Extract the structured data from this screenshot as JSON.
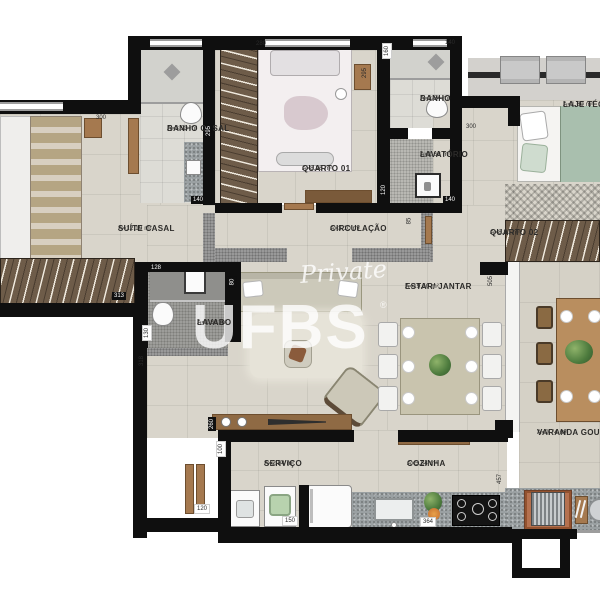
{
  "plan_title": "apartment-floor-plan",
  "watermark": {
    "script": "Private",
    "brand": "UFBS",
    "registered": "®"
  },
  "rooms": [
    {
      "id": "banho-casal",
      "name": "BANHO CASAL",
      "area": "A=3,93 m²"
    },
    {
      "id": "quarto-01",
      "name": "QUARTO 01",
      "area": "A=8,26 m²"
    },
    {
      "id": "banho",
      "name": "BANHO",
      "area": "A=2,24 m²"
    },
    {
      "id": "lavatorio",
      "name": "LAVATÓRIO",
      "area": "A=1,68 m²"
    },
    {
      "id": "laje-tecnica",
      "name": "LAJE TÉCNICA",
      "area": "A=1,60 m²"
    },
    {
      "id": "quarto-02",
      "name": "QUARTO 02",
      "area": "A=8,20 m²"
    },
    {
      "id": "suite-casal",
      "name": "SUÍTE CASAL",
      "area": "A=12,19 m²"
    },
    {
      "id": "circulacao",
      "name": "CIRCULAÇÃO",
      "area": "A=3,10 m²"
    },
    {
      "id": "lavabo",
      "name": "LAVABO",
      "area": "A=1,66 m²"
    },
    {
      "id": "estar-jantar",
      "name": "ESTAR/ JANTAR",
      "area": "A=19,50 m²"
    },
    {
      "id": "varanda-gourmet",
      "name": "VARANDA GOURMET",
      "area": "A=9,74 m²"
    },
    {
      "id": "servico",
      "name": "SERVIÇO",
      "area": "A=2,54 m²"
    },
    {
      "id": "cozinha",
      "name": "COZINHA",
      "area": "A=5,84 m²"
    }
  ],
  "dims": [
    "300",
    "280",
    "295",
    "140",
    "160",
    "140",
    "295",
    "300",
    "120",
    "140",
    "85",
    "128",
    "130",
    "318",
    "313",
    "80",
    "505",
    "457",
    "260",
    "100",
    "120",
    "150",
    "364"
  ],
  "colors": {
    "wall": "#0f0f0f",
    "floor_tile": "#d9d5cb",
    "wood": "#a5794f",
    "wardrobe": "#6e5c49",
    "granite": "#9aa0a2",
    "brick": "#b5714f",
    "plant_green": "#4c7a3d"
  }
}
